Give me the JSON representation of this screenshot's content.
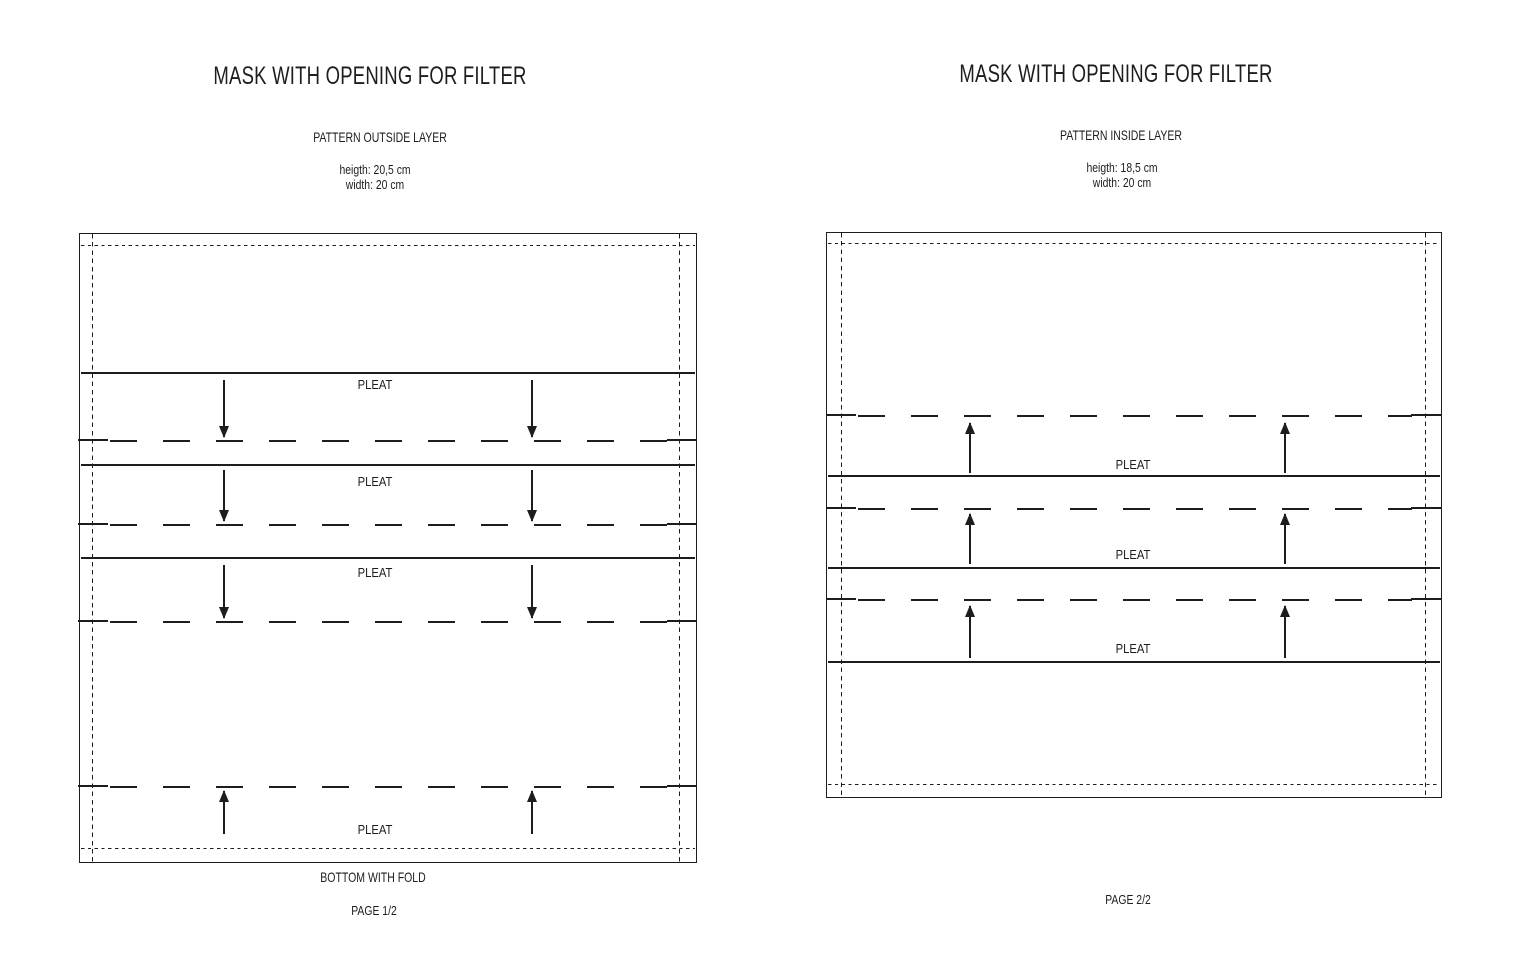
{
  "colors": {
    "ink": "#1d1d1b",
    "background": "#ffffff"
  },
  "page1": {
    "title": "MASK WITH OPENING FOR FILTER",
    "subtitle": "PATTERN OUTSIDE LAYER",
    "height_text": "heigth: 20,5 cm",
    "width_text": "width: 20 cm",
    "pleats": [
      {
        "label": "PLEAT",
        "fold_direction": "down"
      },
      {
        "label": "PLEAT",
        "fold_direction": "down"
      },
      {
        "label": "PLEAT",
        "fold_direction": "down"
      },
      {
        "label": "PLEAT",
        "fold_direction": "up"
      }
    ],
    "bottom_text": "BOTTOM WITH FOLD",
    "page_text": "PAGE 1/2"
  },
  "page2": {
    "title": "MASK WITH OPENING FOR FILTER",
    "subtitle": "PATTERN INSIDE LAYER",
    "height_text": "heigth: 18,5 cm",
    "width_text": "width: 20 cm",
    "pleats": [
      {
        "label": "PLEAT",
        "fold_direction": "up"
      },
      {
        "label": "PLEAT",
        "fold_direction": "up"
      },
      {
        "label": "PLEAT",
        "fold_direction": "up"
      }
    ],
    "page_text": "PAGE 2/2"
  }
}
